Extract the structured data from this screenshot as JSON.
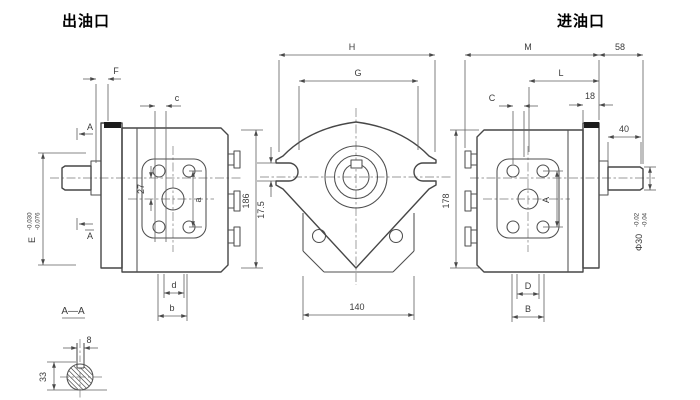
{
  "titles": {
    "outlet": "出油口",
    "inlet": "进油口"
  },
  "left_view": {
    "dim_f": "F",
    "dim_c": "c",
    "shaft_dim": "E",
    "shaft_tol_upper": "-0.030",
    "shaft_tol_lower": "-0.076",
    "section_label_top": "A",
    "section_label_bottom": "A",
    "dim_27": "27",
    "dim_a": "a",
    "dim_height": "186",
    "dim_d": "d",
    "dim_b": "b"
  },
  "center_view": {
    "dim_h": "H",
    "dim_g": "G",
    "dim_slot": "17.5",
    "dim_width": "140"
  },
  "right_view": {
    "dim_height": "178",
    "dim_m": "M",
    "dim_58": "58",
    "dim_l": "L",
    "dim_c": "C",
    "dim_18": "18",
    "dim_40": "40",
    "shaft_dim": "Φ30",
    "shaft_tol_upper": "-0.02",
    "shaft_tol_lower": "-0.04",
    "dim_a": "A",
    "dim_d": "D",
    "dim_b": "B"
  },
  "section_view": {
    "title": "A—A",
    "dim_key_width": "8",
    "dim_33": "33"
  }
}
